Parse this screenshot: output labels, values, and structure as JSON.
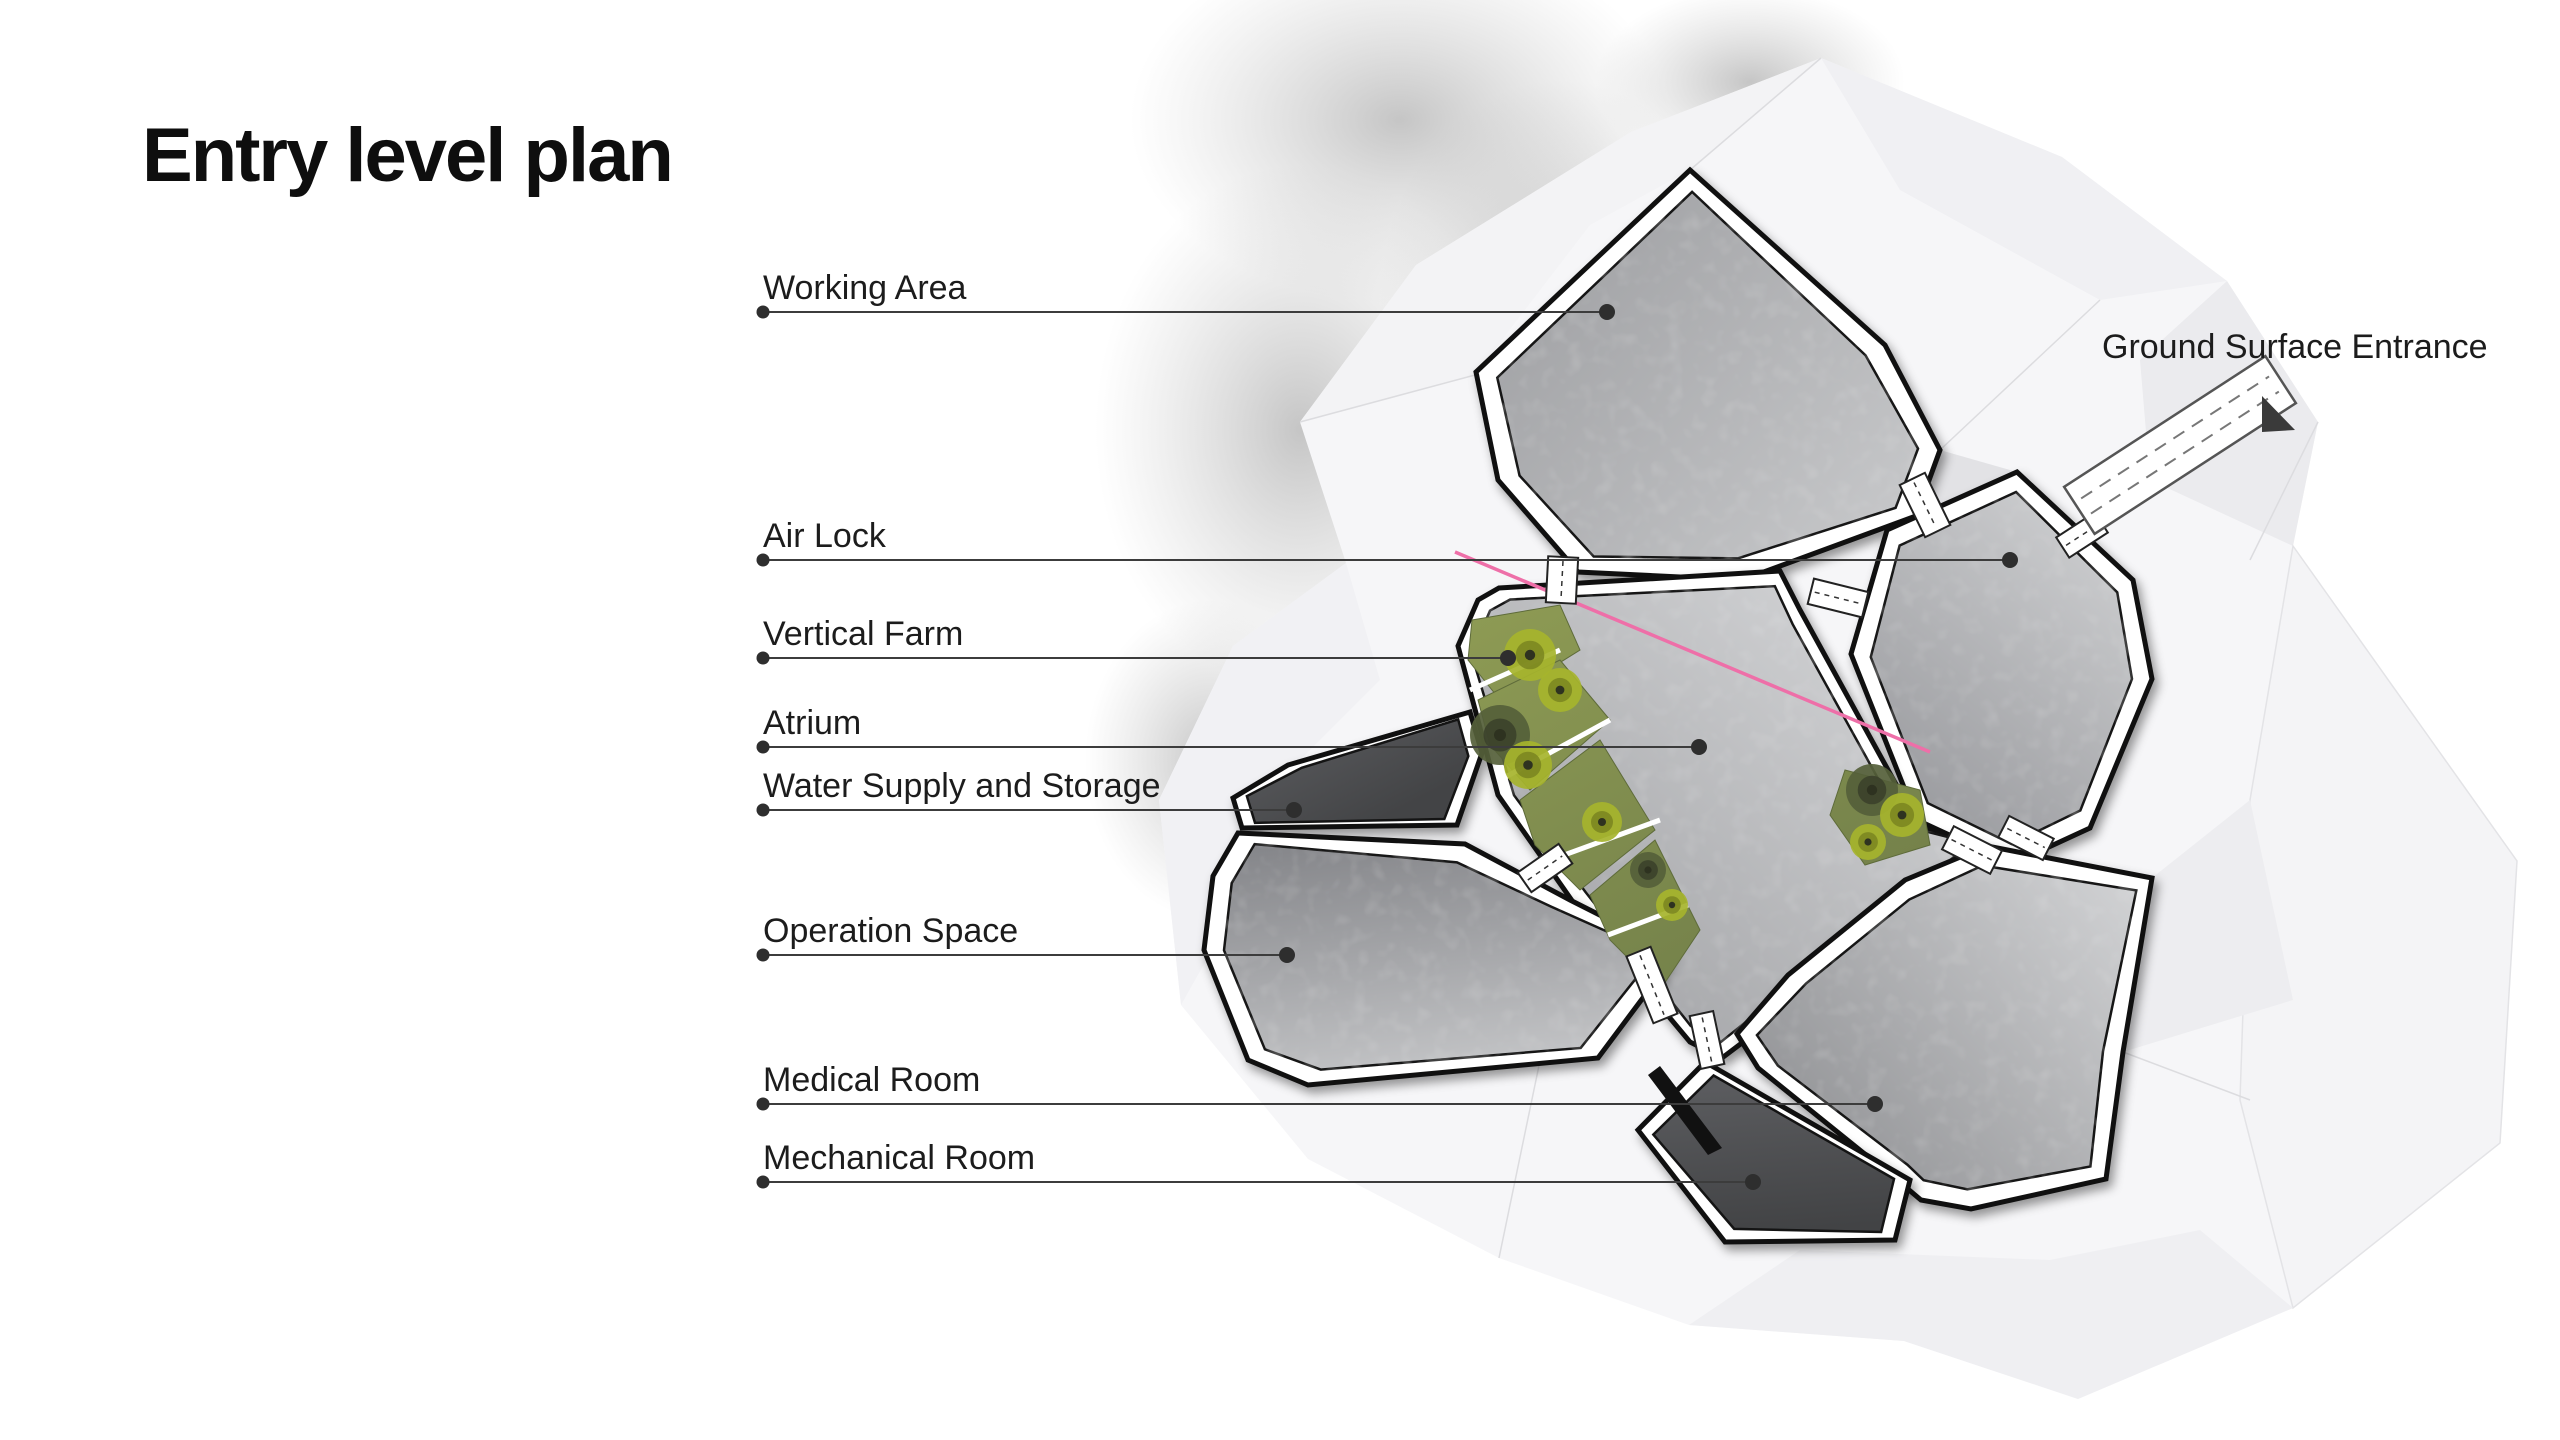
{
  "page": {
    "title": "Entry level plan",
    "background": "#ffffff"
  },
  "plan": {
    "annotations": [
      {
        "id": "working-area",
        "label": "Working Area",
        "text_x": 763,
        "text_y": 268,
        "line": {
          "x1": 763,
          "y1": 312,
          "x2": 1607,
          "y2": 312
        }
      },
      {
        "id": "air-lock",
        "label": "Air Lock",
        "text_x": 763,
        "text_y": 516,
        "line": {
          "x1": 763,
          "y1": 560,
          "x2": 2010,
          "y2": 560
        }
      },
      {
        "id": "vertical-farm",
        "label": "Vertical Farm",
        "text_x": 763,
        "text_y": 614,
        "line": {
          "x1": 763,
          "y1": 658,
          "x2": 1508,
          "y2": 658
        }
      },
      {
        "id": "atrium",
        "label": "Atrium",
        "text_x": 763,
        "text_y": 703,
        "line": {
          "x1": 763,
          "y1": 747,
          "x2": 1699,
          "y2": 747
        }
      },
      {
        "id": "water-supply-and-storage",
        "label": "Water Supply and Storage",
        "text_x": 763,
        "text_y": 766,
        "line": {
          "x1": 763,
          "y1": 810,
          "x2": 1294,
          "y2": 810
        }
      },
      {
        "id": "operation-space",
        "label": "Operation Space",
        "text_x": 763,
        "text_y": 911,
        "line": {
          "x1": 763,
          "y1": 955,
          "x2": 1287,
          "y2": 955
        }
      },
      {
        "id": "medical-room",
        "label": "Medical Room",
        "text_x": 763,
        "text_y": 1060,
        "line": {
          "x1": 763,
          "y1": 1104,
          "x2": 1875,
          "y2": 1104
        }
      },
      {
        "id": "mechanical-room",
        "label": "Mechanical Room",
        "text_x": 763,
        "text_y": 1138,
        "line": {
          "x1": 763,
          "y1": 1182,
          "x2": 1753,
          "y2": 1182
        }
      },
      {
        "id": "ground-surface-entrance",
        "label": "Ground Surface Entrance",
        "text_x": 2102,
        "text_y": 327,
        "line": null
      }
    ],
    "colors": {
      "label_text": "#1c1c1c",
      "leader_line": "#3c3c3c",
      "leader_dot": "#2e2e2e",
      "wall_outline": "#101010",
      "wall_fill": "#ffffff",
      "dark_room": "#4d4e50",
      "rock_base": "#f6f6f8",
      "vegetation_bright": "#a6b42c",
      "vegetation_dark": "#55603a",
      "grass": "#85924f",
      "accent_pink": "#ee6fa8",
      "entrance_arrow": "#3a3a3a"
    }
  }
}
